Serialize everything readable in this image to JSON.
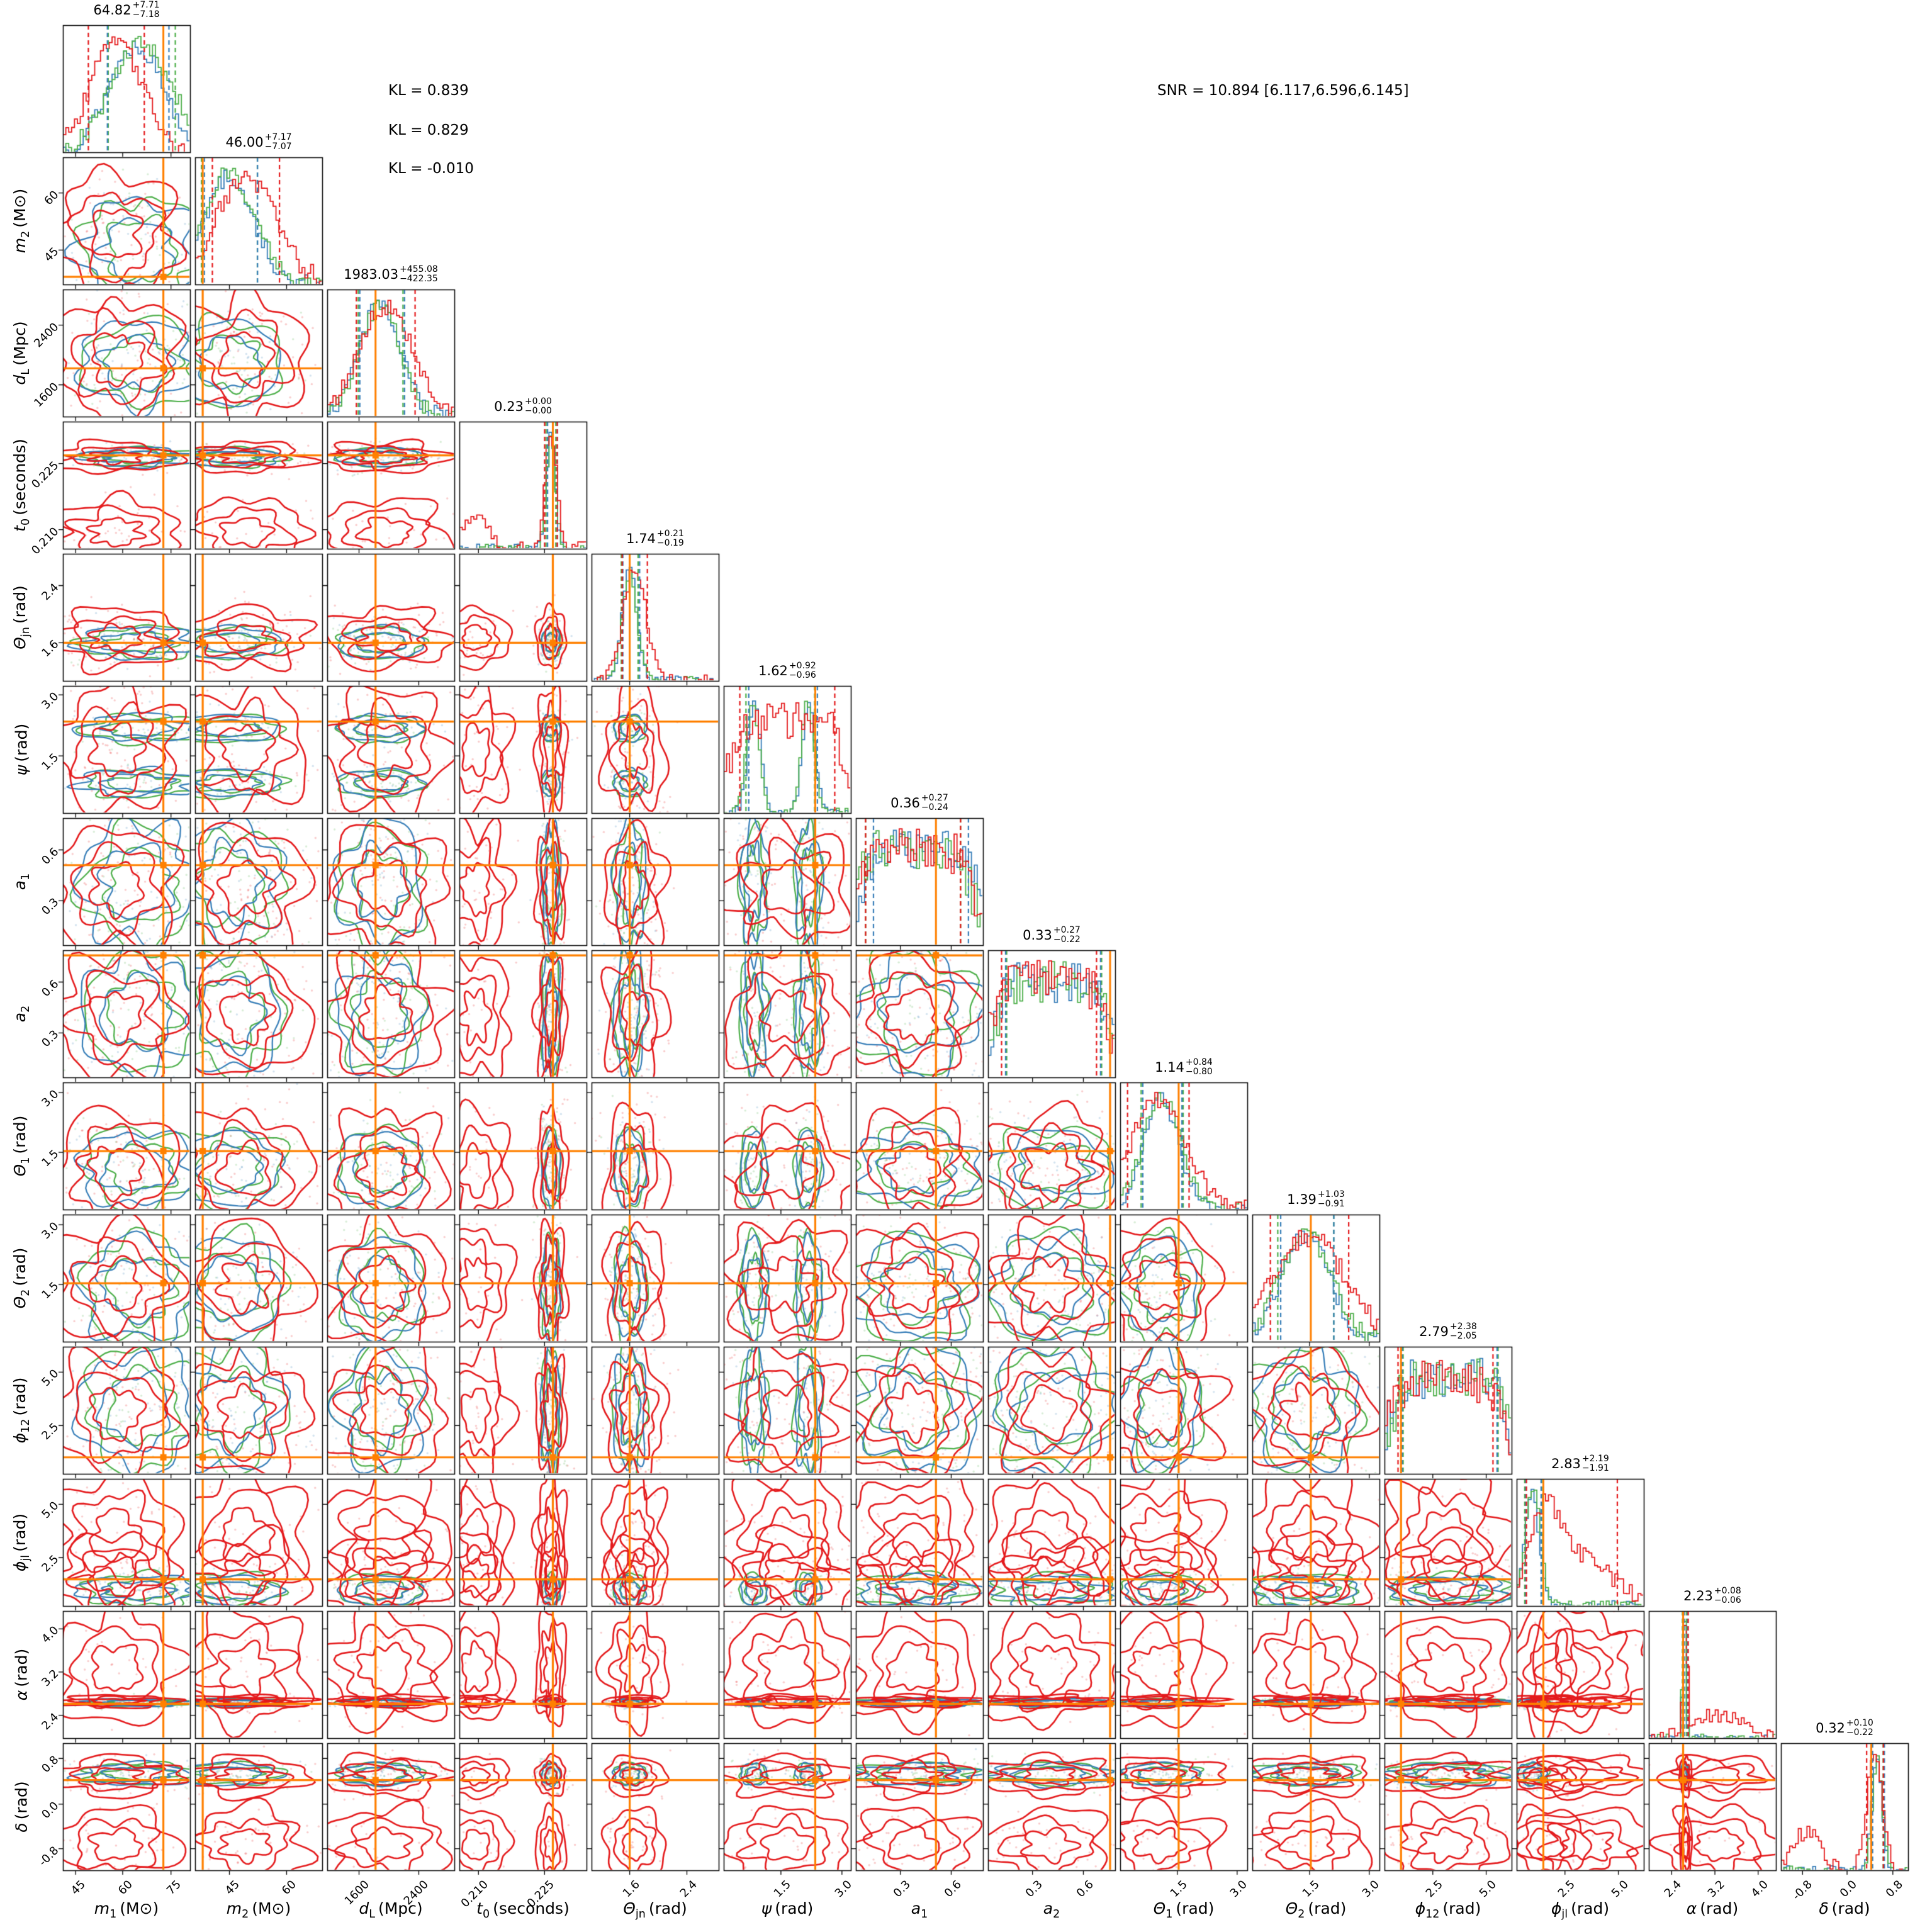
{
  "annotations": {
    "kl": [
      "KL = 0.839",
      "KL = 0.829",
      "KL = -0.010"
    ],
    "snr": "SNR = 10.894 [6.117,6.596,6.145]"
  },
  "chart_data": {
    "type": "corner",
    "description": "14-parameter posterior corner plot comparing three runs (red, green, blue histograms and contours) with orange injected-value crosshairs",
    "legend_position": "none",
    "grid": false,
    "colors": {
      "run_red": "#e41a1c",
      "run_green": "#4daf4a",
      "run_blue": "#377eb8",
      "truth": "#ff8000",
      "axes": "#000000"
    },
    "layout": {
      "margin_left": 100,
      "margin_top": 40,
      "panel_size": 202,
      "panel_pitch": 210,
      "n_params": 14
    },
    "parameters": [
      {
        "name": "m1",
        "label": {
          "base": "m",
          "sub": "1",
          "unit": "(M⊙)"
        },
        "title": {
          "median": "64.82",
          "plus": "+7.71",
          "minus": "−7.18"
        },
        "ticks": [
          "45",
          "60",
          "75"
        ],
        "tick_fracs": [
          0.1,
          0.47,
          0.85
        ],
        "truth_frac": 0.79,
        "hist": {
          "red": [
            {
              "c": 0.42,
              "w": 0.2,
              "a": 1
            }
          ],
          "green": [
            {
              "c": 0.62,
              "w": 0.24,
              "a": 1
            }
          ],
          "blue": [
            {
              "c": 0.58,
              "w": 0.22,
              "a": 1
            }
          ]
        }
      },
      {
        "name": "m2",
        "label": {
          "base": "m",
          "sub": "2",
          "unit": "(M⊙)"
        },
        "title": {
          "median": "46.00",
          "plus": "+7.17",
          "minus": "−7.07"
        },
        "ticks": [
          "45",
          "60"
        ],
        "tick_fracs": [
          0.27,
          0.72
        ],
        "truth_frac": 0.06,
        "hist": {
          "red": [
            {
              "c": 0.4,
              "w": 0.24,
              "a": 1
            }
          ],
          "green": [
            {
              "c": 0.27,
              "w": 0.2,
              "a": 1
            }
          ],
          "blue": [
            {
              "c": 0.27,
              "w": 0.19,
              "a": 1
            }
          ]
        }
      },
      {
        "name": "dL",
        "label": {
          "base": "d",
          "sub": "L",
          "unit": "(Mpc)"
        },
        "title": {
          "median": "1983.03",
          "plus": "+455.08",
          "minus": "−422.35"
        },
        "ticks": [
          "1600",
          "2400"
        ],
        "tick_fracs": [
          0.25,
          0.72
        ],
        "truth_frac": 0.38,
        "hist": {
          "red": [
            {
              "c": 0.46,
              "w": 0.21,
              "a": 1
            }
          ],
          "green": [
            {
              "c": 0.42,
              "w": 0.16,
              "a": 1
            }
          ],
          "blue": [
            {
              "c": 0.42,
              "w": 0.16,
              "a": 1
            }
          ]
        }
      },
      {
        "name": "t0",
        "label": {
          "base": "t",
          "sub": "0",
          "unit": "(seconds)"
        },
        "title": {
          "median": "0.23",
          "plus": "+0.00",
          "minus": "−0.00"
        },
        "ticks": [
          "0.210",
          "0.225"
        ],
        "tick_fracs": [
          0.15,
          0.67
        ],
        "truth_frac": 0.735,
        "hist": {
          "red": [
            {
              "c": 0.72,
              "w": 0.045,
              "a": 1
            },
            {
              "c": 0.13,
              "w": 0.1,
              "a": 0.25
            }
          ],
          "green": [
            {
              "c": 0.72,
              "w": 0.035,
              "a": 1
            }
          ],
          "blue": [
            {
              "c": 0.72,
              "w": 0.035,
              "a": 1
            }
          ]
        }
      },
      {
        "name": "theta_jn",
        "label": {
          "base": "Θ",
          "sub": "jn",
          "unit": "(rad)"
        },
        "title": {
          "median": "1.74",
          "plus": "+0.21",
          "minus": "−0.19"
        },
        "ticks": [
          "1.6",
          "2.4"
        ],
        "tick_fracs": [
          0.3,
          0.75
        ],
        "truth_frac": 0.3,
        "hist": {
          "red": [
            {
              "c": 0.34,
              "w": 0.09,
              "a": 1
            }
          ],
          "green": [
            {
              "c": 0.3,
              "w": 0.06,
              "a": 1
            }
          ],
          "blue": [
            {
              "c": 0.3,
              "w": 0.06,
              "a": 1
            }
          ]
        }
      },
      {
        "name": "psi",
        "label": {
          "base": "ψ",
          "sub": "",
          "unit": "(rad)"
        },
        "title": {
          "median": "1.62",
          "plus": "+0.92",
          "minus": "−0.96"
        },
        "ticks": [
          "1.5",
          "3.0"
        ],
        "tick_fracs": [
          0.45,
          0.93
        ],
        "truth_frac": 0.72,
        "hist": {
          "red": [
            {
              "c": 0.5,
              "w": 0.45,
              "a": 0.75
            }
          ],
          "green": [
            {
              "c": 0.23,
              "w": 0.05,
              "a": 1
            },
            {
              "c": 0.66,
              "w": 0.05,
              "a": 1
            }
          ],
          "blue": [
            {
              "c": 0.24,
              "w": 0.05,
              "a": 1
            },
            {
              "c": 0.67,
              "w": 0.05,
              "a": 1
            }
          ]
        }
      },
      {
        "name": "a1",
        "label": {
          "base": "a",
          "sub": "1",
          "unit": ""
        },
        "title": {
          "median": "0.36",
          "plus": "+0.27",
          "minus": "−0.24"
        },
        "ticks": [
          "0.3",
          "0.6"
        ],
        "tick_fracs": [
          0.35,
          0.75
        ],
        "truth_frac": 0.63,
        "hist": {
          "red": [
            {
              "c": 0.45,
              "w": 0.45,
              "a": 0.7
            }
          ],
          "green": [
            {
              "c": 0.45,
              "w": 0.45,
              "a": 0.7
            }
          ],
          "blue": [
            {
              "c": 0.5,
              "w": 0.45,
              "a": 0.72
            }
          ]
        }
      },
      {
        "name": "a2",
        "label": {
          "base": "a",
          "sub": "2",
          "unit": ""
        },
        "title": {
          "median": "0.33",
          "plus": "+0.27",
          "minus": "−0.22"
        },
        "ticks": [
          "0.3",
          "0.6"
        ],
        "tick_fracs": [
          0.35,
          0.75
        ],
        "truth_frac": 0.96,
        "hist": {
          "red": [
            {
              "c": 0.48,
              "w": 0.45,
              "a": 0.7
            }
          ],
          "green": [
            {
              "c": 0.52,
              "w": 0.45,
              "a": 0.7
            }
          ],
          "blue": [
            {
              "c": 0.5,
              "w": 0.45,
              "a": 0.7
            }
          ]
        }
      },
      {
        "name": "theta_1",
        "label": {
          "base": "Θ",
          "sub": "1",
          "unit": "(rad)"
        },
        "title": {
          "median": "1.14",
          "plus": "+0.84",
          "minus": "−0.80"
        },
        "ticks": [
          "1.5",
          "3.0"
        ],
        "tick_fracs": [
          0.45,
          0.92
        ],
        "truth_frac": 0.46,
        "hist": {
          "red": [
            {
              "c": 0.3,
              "w": 0.22,
              "a": 1
            }
          ],
          "green": [
            {
              "c": 0.33,
              "w": 0.15,
              "a": 1
            }
          ],
          "blue": [
            {
              "c": 0.32,
              "w": 0.14,
              "a": 1
            }
          ]
        }
      },
      {
        "name": "theta_2",
        "label": {
          "base": "Θ",
          "sub": "2",
          "unit": "(rad)"
        },
        "title": {
          "median": "1.39",
          "plus": "+1.03",
          "minus": "−0.91"
        },
        "ticks": [
          "1.5",
          "3.0"
        ],
        "tick_fracs": [
          0.45,
          0.92
        ],
        "truth_frac": 0.46,
        "hist": {
          "red": [
            {
              "c": 0.45,
              "w": 0.28,
              "a": 1
            }
          ],
          "green": [
            {
              "c": 0.42,
              "w": 0.2,
              "a": 1
            }
          ],
          "blue": [
            {
              "c": 0.42,
              "w": 0.19,
              "a": 1
            }
          ]
        }
      },
      {
        "name": "phi_12",
        "label": {
          "base": "ϕ",
          "sub": "12",
          "unit": "(rad)"
        },
        "title": {
          "median": "2.79",
          "plus": "+2.38",
          "minus": "−2.05"
        },
        "ticks": [
          "2.5",
          "5.0"
        ],
        "tick_fracs": [
          0.38,
          0.8
        ],
        "truth_frac": 0.13,
        "hist": {
          "red": [
            {
              "c": 0.48,
              "w": 0.45,
              "a": 0.7
            }
          ],
          "green": [
            {
              "c": 0.52,
              "w": 0.45,
              "a": 0.7
            }
          ],
          "blue": [
            {
              "c": 0.5,
              "w": 0.45,
              "a": 0.7
            }
          ]
        }
      },
      {
        "name": "phi_jl",
        "label": {
          "base": "ϕ",
          "sub": "jl",
          "unit": "(rad)"
        },
        "title": {
          "median": "2.83",
          "plus": "+2.19",
          "minus": "−1.91"
        },
        "ticks": [
          "2.5",
          "5.0"
        ],
        "tick_fracs": [
          0.38,
          0.8
        ],
        "truth_frac": 0.21,
        "hist": {
          "red": [
            {
              "c": 0.22,
              "w": 0.13,
              "a": 0.9
            },
            {
              "c": 0.55,
              "w": 0.22,
              "a": 0.45
            }
          ],
          "green": [
            {
              "c": 0.13,
              "w": 0.06,
              "a": 1
            }
          ],
          "blue": [
            {
              "c": 0.12,
              "w": 0.055,
              "a": 1
            }
          ]
        }
      },
      {
        "name": "alpha",
        "label": {
          "base": "α",
          "sub": "",
          "unit": "(rad)"
        },
        "title": {
          "median": "2.23",
          "plus": "+0.08",
          "minus": "−0.06"
        },
        "ticks": [
          "2.4",
          "3.2",
          "4.0"
        ],
        "tick_fracs": [
          0.18,
          0.52,
          0.86
        ],
        "truth_frac": 0.27,
        "hist": {
          "red": [
            {
              "c": 0.29,
              "w": 0.018,
              "a": 1
            },
            {
              "c": 0.55,
              "w": 0.17,
              "a": 0.22
            }
          ],
          "green": [
            {
              "c": 0.28,
              "w": 0.014,
              "a": 1
            }
          ],
          "blue": [
            {
              "c": 0.28,
              "w": 0.013,
              "a": 1
            }
          ]
        }
      },
      {
        "name": "delta",
        "label": {
          "base": "δ",
          "sub": "",
          "unit": "(rad)"
        },
        "title": {
          "median": "0.32",
          "plus": "+0.10",
          "minus": "−0.22"
        },
        "ticks": [
          "-0.8",
          "0.0",
          "0.8"
        ],
        "tick_fracs": [
          0.17,
          0.52,
          0.88
        ],
        "truth_frac": 0.71,
        "hist": {
          "red": [
            {
              "c": 0.74,
              "w": 0.06,
              "a": 0.9
            },
            {
              "c": 0.2,
              "w": 0.11,
              "a": 0.28
            }
          ],
          "green": [
            {
              "c": 0.76,
              "w": 0.04,
              "a": 1
            }
          ],
          "blue": [
            {
              "c": 0.755,
              "w": 0.042,
              "a": 1
            }
          ]
        }
      }
    ]
  }
}
